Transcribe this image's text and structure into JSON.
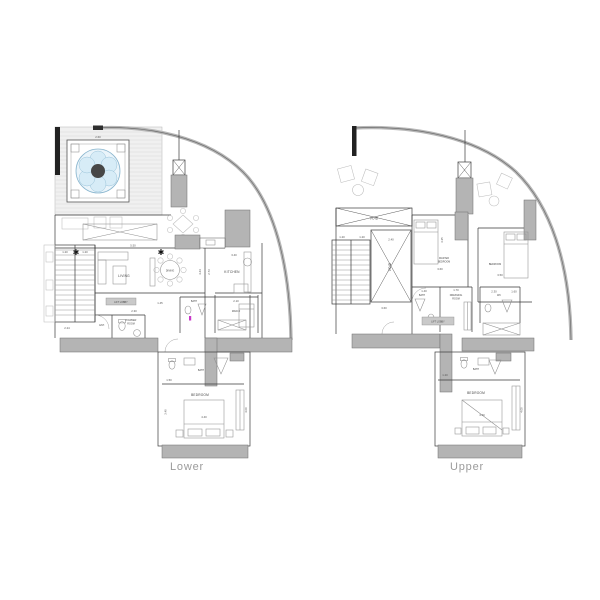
{
  "captions": {
    "lower": "Lower",
    "upper": "Upper"
  },
  "colors": {
    "accent_pool": "#7fb5d6",
    "wall_fill": "#b4b4b4",
    "line": "#3a3a3a",
    "caption_text": "#9b9b9b",
    "marker_magenta": "#c837c8"
  },
  "lower": {
    "rooms": {
      "living": "LIVING",
      "dining": "DINING",
      "kitchen": "KITCHEN",
      "powder1": "POWDER",
      "powder2": "ROOM",
      "ent": "ENT.",
      "bath_mid": "BATH",
      "maid": "MAID.R",
      "bath": "BATH",
      "bedroom": "BEDROOM",
      "lobby": "LIFT LOBBY"
    },
    "dims": {
      "jacuzzi": "2.60",
      "living_w": "5.50",
      "living_h": "4.44",
      "kitchen_w": "3.40",
      "kitchen_h": "2.73",
      "stair_a": "1.20",
      "stair_b": "1.20",
      "stair_c": "2.24",
      "hall": "2.30",
      "corr": "1.45",
      "maid_w": "2.10",
      "bath_w": "1.50",
      "bed_w": "4.40",
      "bed_h": "4.00",
      "bed_side": "3.40"
    }
  },
  "upper": {
    "rooms": {
      "void_band": "VOID",
      "void_box": "VOID",
      "master1": "MASTER",
      "master2": "BEDROOM",
      "bedroom": "BEDROOM",
      "bath": "BATH",
      "dressing1": "DRESSING",
      "dressing2": "ROOM",
      "wc": "WC",
      "bath_low": "BATH",
      "bedroom_low": "BEDROOM",
      "lobby": "LIFT LOBBY"
    },
    "dims": {
      "void_w": "2.40",
      "void_b": "3.60",
      "stair_a": "1.20",
      "stair_b": "1.20",
      "master_w": "3.60",
      "master_h": "3.35",
      "bedroom_w": "3.50",
      "bath_t": "1.40",
      "dressing_t": "1.70",
      "wc_a": "2.30",
      "wc_b": "1.60",
      "bath_low_l": "1.20",
      "bed_w": "4.40",
      "bed_h": "4.00"
    }
  }
}
